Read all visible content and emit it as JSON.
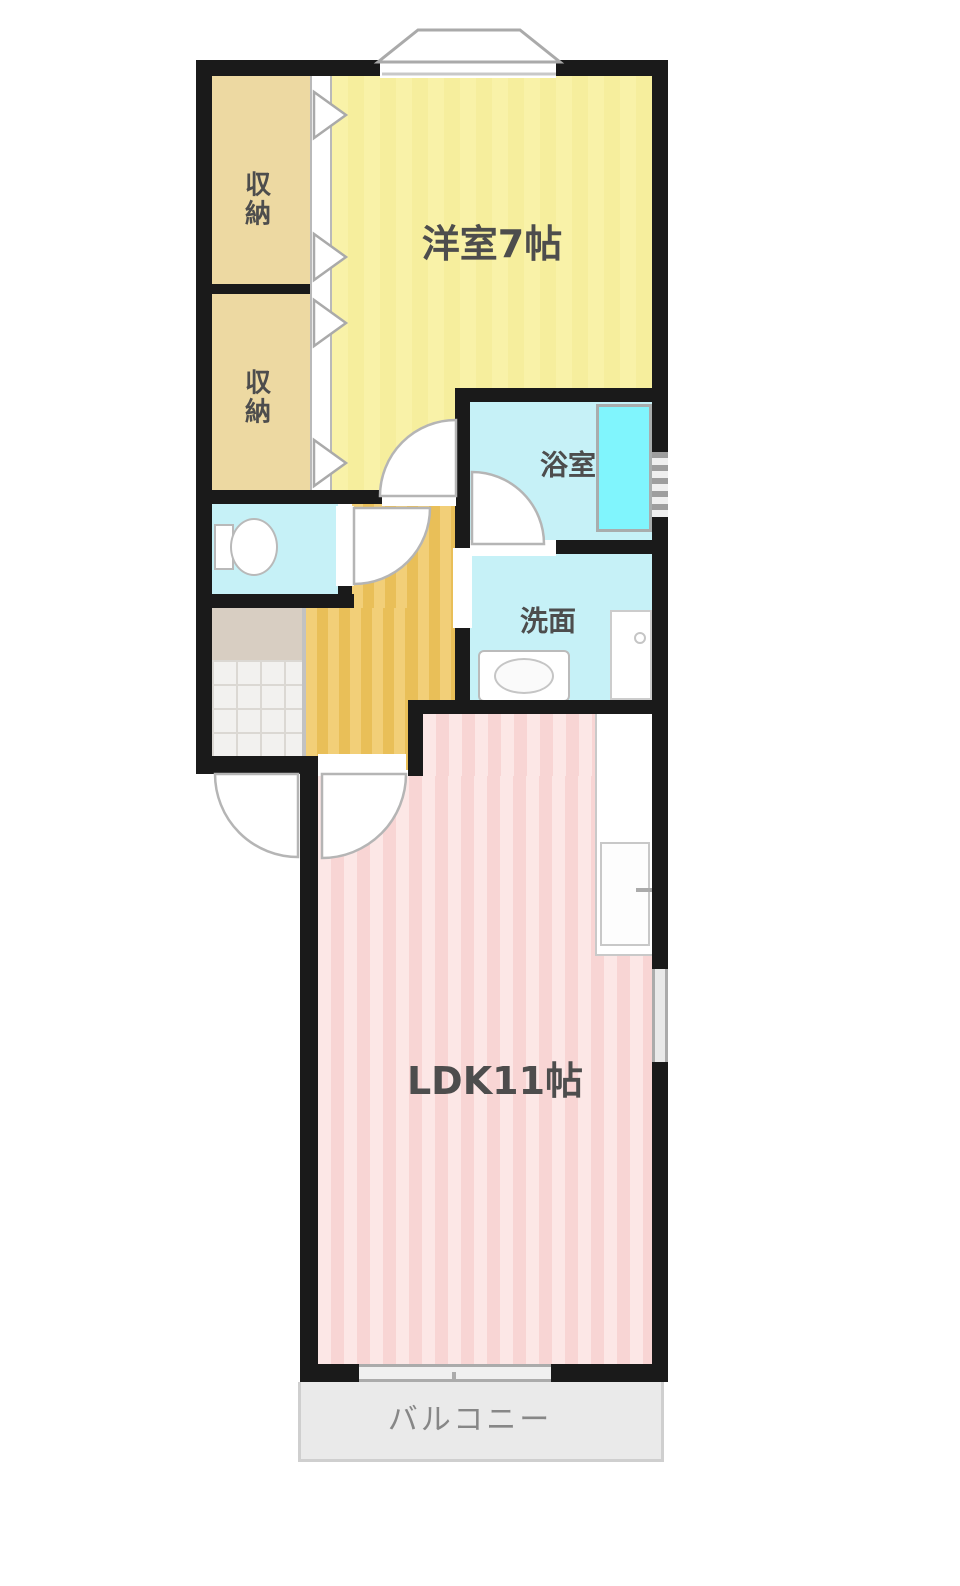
{
  "floor_plan": {
    "type": "japanese-apartment-floorplan-1LDK",
    "rooms": {
      "western_room": {
        "label": "洋室7帖"
      },
      "closet_top": {
        "label": "収納"
      },
      "closet_bottom": {
        "label": "収納"
      },
      "bathroom": {
        "label": "浴室"
      },
      "washroom": {
        "label": "洗面"
      },
      "ldk": {
        "label": "LDK11帖"
      },
      "balcony": {
        "label": "バルコニー"
      }
    },
    "colors": {
      "wall": "#1a1a1a",
      "western": "#f9f2a8",
      "western_stripe": "#f6ee9d",
      "closet": "#edd9a2",
      "hallway": "#f2cf78",
      "hallway_stripe": "#e9bf58",
      "water": "#c6f1f7",
      "bathtub": "#80f5fd",
      "ldk": "#fce7e6",
      "ldk_stripe": "#f8d5d4",
      "balcony_bg": "#eaeaea",
      "step": "#d8cec2",
      "tile": "#f2f1ef",
      "label": "#4d4d4d",
      "balcony_label": "#878787"
    }
  }
}
